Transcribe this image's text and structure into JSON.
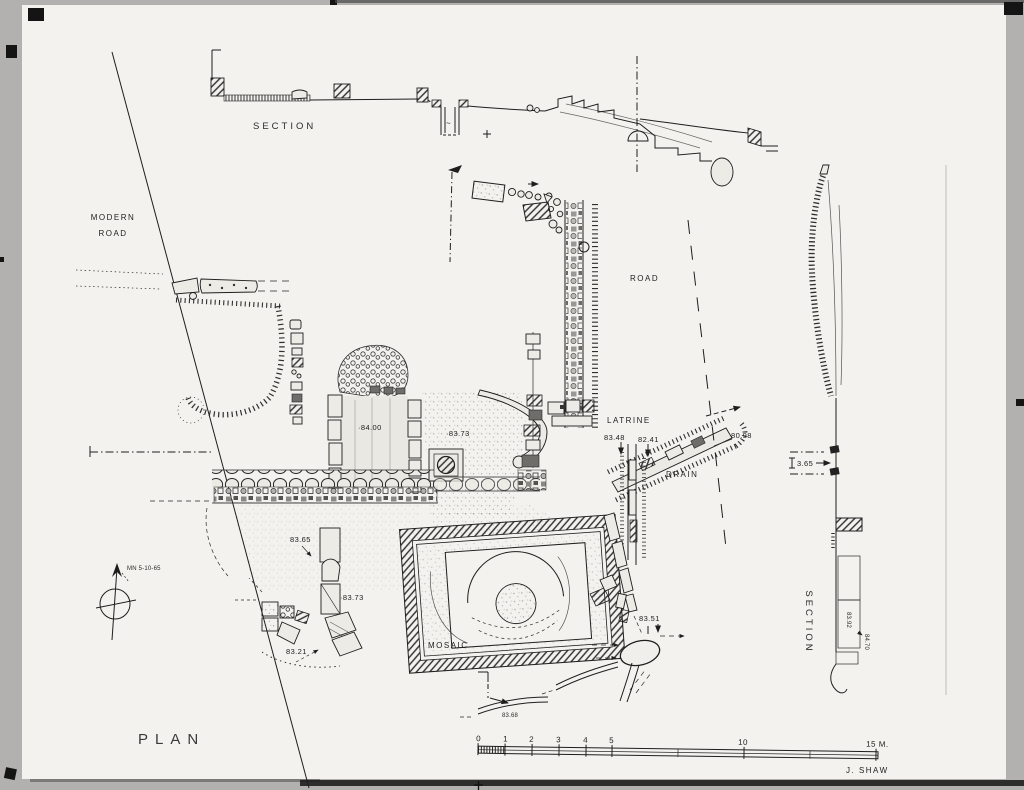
{
  "colors": {
    "background": "#b3b1af",
    "paper": "#f3f2ee",
    "ink": "#1e1e1e"
  },
  "titles": {
    "plan": "PLAN",
    "section_top": "SECTION",
    "section_right": "SECTION"
  },
  "credit": {
    "author": "J. SHAW"
  },
  "labels": {
    "modern_road_line1": "MODERN",
    "modern_road_line2": "ROAD",
    "road": "ROAD",
    "latrine": "LATRINE",
    "drain": "DRAIN",
    "mosaic": "MOSAIC",
    "north_note": "MN 5-10-65"
  },
  "elevations": {
    "room": "·84.00",
    "court": "·83.73",
    "latrine_w": "83.48",
    "latrine_e": "82.41",
    "drain_end": "80.98",
    "west_wall": "83.65",
    "blocks": "·83.73",
    "sw_stones": "83.21",
    "oval": "83.51",
    "south_channel": "83.68",
    "section_offset": "3.65",
    "section_a": "83.92",
    "section_b": "84.70"
  },
  "scale_bar": {
    "ticks": [
      "0",
      "1",
      "2",
      "3",
      "4",
      "5",
      "10",
      "15 M."
    ]
  }
}
